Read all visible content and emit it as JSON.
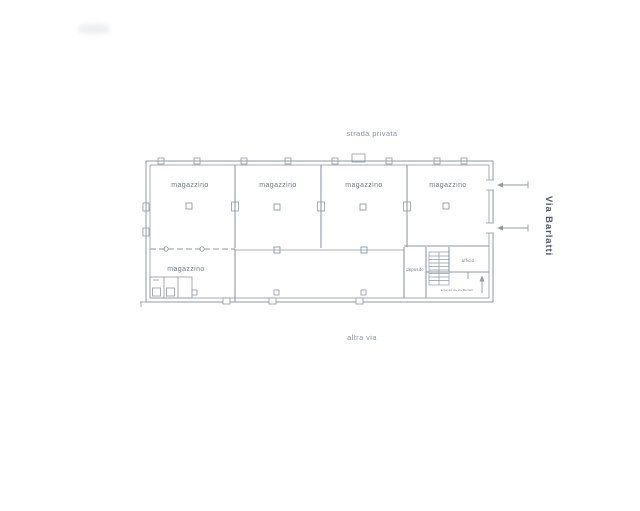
{
  "streets": {
    "top": "strada privata",
    "right": "Via Barlatti",
    "bottom": "altra via"
  },
  "rooms": {
    "magazzini": [
      {
        "label": "magazzino"
      },
      {
        "label": "magazzino"
      },
      {
        "label": "magazzino"
      },
      {
        "label": "magazzino"
      },
      {
        "label": "magazzino"
      }
    ],
    "deposito_label": "deposito",
    "office_label": "ufficio",
    "corridor_note": "accesso da via Barlatti"
  },
  "colors": {
    "paper": "#ffffff",
    "line": "#8f9aa5",
    "line_light": "#a8b2bb",
    "room_text": "#6e7a86",
    "street_text": "#8b96a1",
    "street_text_dark": "#4e5864"
  }
}
